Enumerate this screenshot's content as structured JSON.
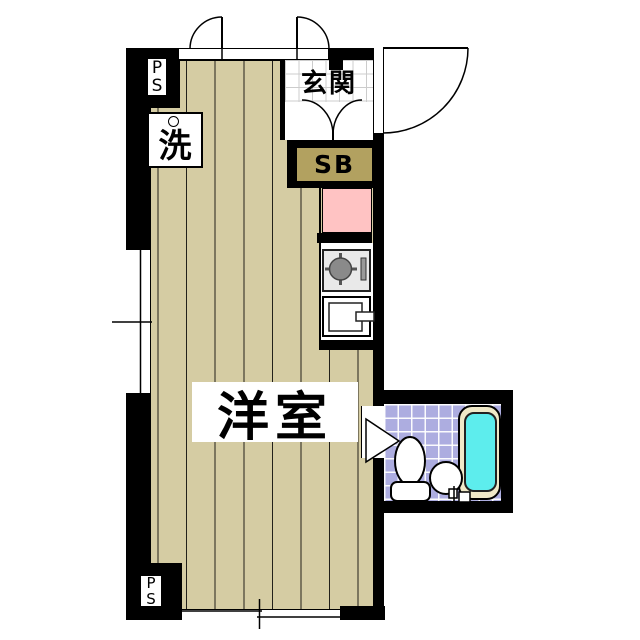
{
  "floorplan": {
    "labels": {
      "main_room": "洋室",
      "entrance": "玄関",
      "shoe_box": "SB",
      "laundry": "洗",
      "ps_top": {
        "line1": "P",
        "line2": "S"
      },
      "ps_bottom": {
        "line1": "P",
        "line2": "S"
      }
    },
    "rooms": [
      {
        "name": "western-room",
        "label": "洋室",
        "floor": "wood planks"
      },
      {
        "name": "entrance",
        "label": "玄関",
        "floor": "tile"
      },
      {
        "name": "bathroom",
        "floor": "lavender tile",
        "fixtures": [
          "toilet",
          "wash-basin",
          "bathtub"
        ]
      },
      {
        "name": "kitchen-column",
        "fixtures": [
          "counter-pink",
          "stove",
          "sink"
        ]
      }
    ],
    "colors": {
      "background": "#ffffff",
      "wall": "#000000",
      "flooring": "#d5cca3",
      "plank_line": "#22201a",
      "shoe_box_fill": "#b2a160",
      "counter_pink": "#ffc3c3",
      "bathroom_tile": "#adade0",
      "bathtub_water": "#5deded",
      "bathtub_rim": "#f0e9c8",
      "stove_panel": "#e9e9e9",
      "burner": "#8a8a8a",
      "entrance_tile_line": "#cccccc"
    }
  }
}
